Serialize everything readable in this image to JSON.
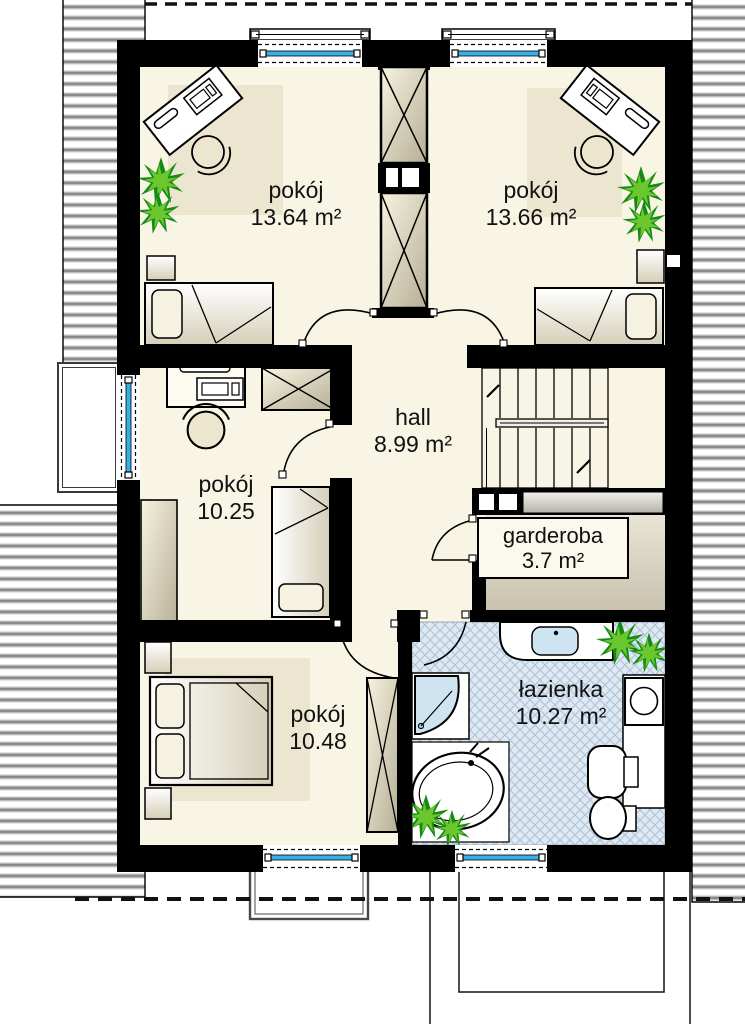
{
  "floorplan": {
    "rooms": [
      {
        "name": "pokój",
        "area": "13.64 m²"
      },
      {
        "name": "pokój",
        "area": "13.66 m²"
      },
      {
        "name": "pokój",
        "area": "10.25"
      },
      {
        "name": "hall",
        "area": "8.99 m²"
      },
      {
        "name": "garderoba",
        "area": "3.7 m²"
      },
      {
        "name": "pokój",
        "area": "10.48"
      },
      {
        "name": "łazienka",
        "area": "10.27 m²"
      }
    ],
    "colors": {
      "wall": "#000000",
      "floor": "#f8f5e4",
      "rug": "#ece5cf",
      "window_glass": "#35b1e8",
      "bathroom_tile": "#dde9f3",
      "tile_line": "#b5c4d6",
      "fixture_blue": "#cfe4f1",
      "garderoba_floor": "#d6d0bd",
      "plant_green": "#1f9c1f",
      "roof_stripe": "#8f8f8f"
    },
    "fixtures": [
      "bed-icon",
      "double-bed-icon",
      "desk-icon",
      "chair-icon",
      "wardrobe-icon",
      "stairs-icon",
      "shower-icon",
      "bathtub-icon",
      "sink-icon",
      "toilet-icon",
      "bidet-icon",
      "washing-machine-icon",
      "plant-icon",
      "window-icon",
      "door-icon",
      "chimney-flue-icon",
      "balcony-icon",
      "terrace-icon",
      "roof-icon"
    ]
  }
}
